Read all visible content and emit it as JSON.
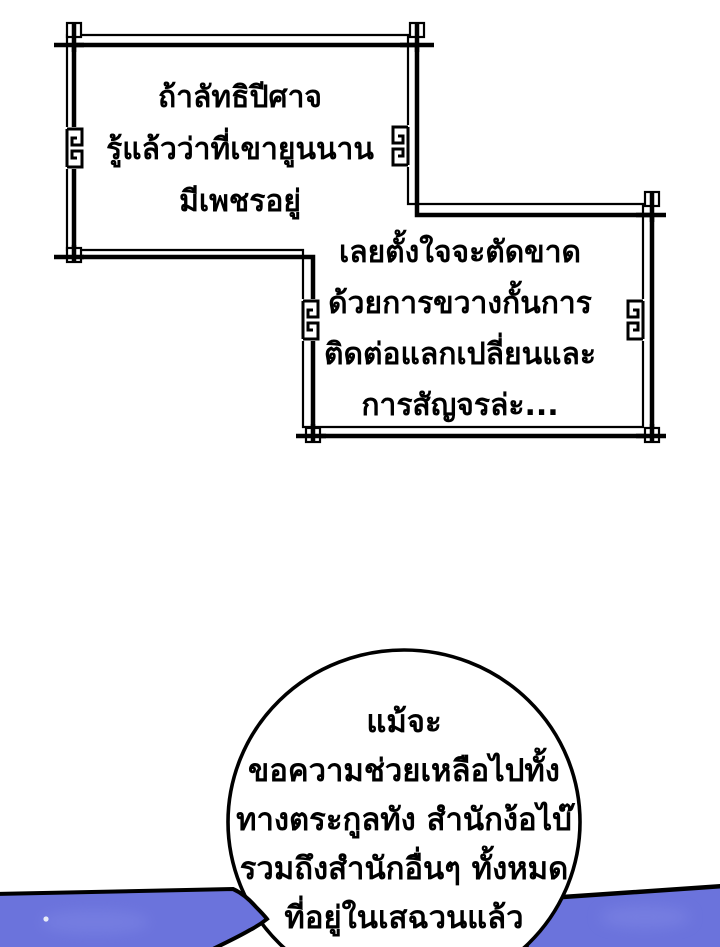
{
  "narration_box_1": {
    "lines": [
      "ถ้าลัทธิปีศาจ",
      "รู้แล้วว่าที่เขายูนนาน",
      "มีเพชรอยู่"
    ]
  },
  "narration_box_2": {
    "lines": [
      "เลยตั้งใจจะตัดขาด",
      "ด้วยการขวางกั้นการ",
      "ติดต่อแลกเปลี่ยนและ",
      "การสัญจรล่ะ..."
    ]
  },
  "speech_bubble": {
    "lines": [
      "แม้จะ",
      "ขอความช่วยเหลือไปทั้ง",
      "ทางตระกูลทัง สำนักง้อไบ๊",
      "รวมถึงสำนักอื่นๆ ทั้งหมด",
      "ที่อยู่ในเสฉวนแล้ว"
    ]
  },
  "colors": {
    "ink": "#000000",
    "paper": "#ffffff",
    "roof_blue": "#6b73dc",
    "roof_blue_light": "#8289e6",
    "speck": "#e8ebf7"
  }
}
